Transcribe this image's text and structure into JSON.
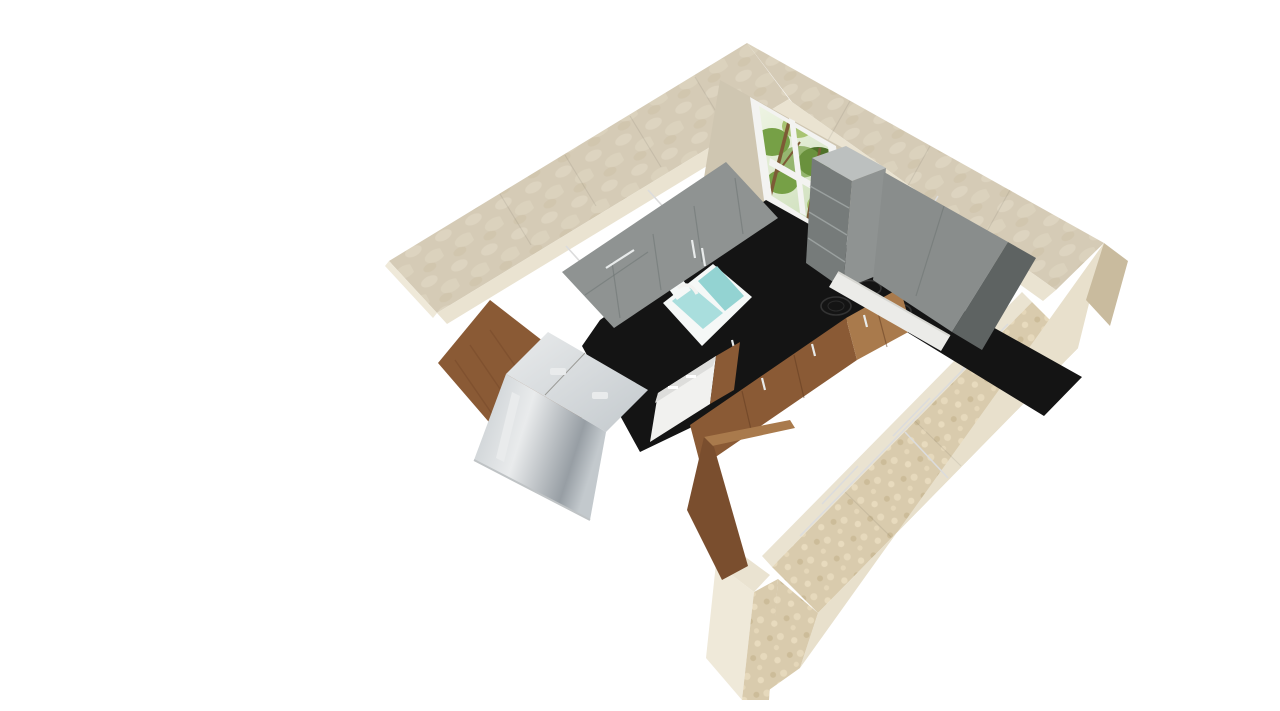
{
  "app": {
    "title": "3D Kitchen Plan View"
  },
  "canvas": {
    "width": 1280,
    "height": 711,
    "background": "#ffffff"
  },
  "colors": {
    "bg": "#ffffff",
    "wall_stone_base": "#d5cbb6",
    "wall_stone_light": "#e4dbc8",
    "wall_top_strip": "#eae3d1",
    "wall_mosaic": "#d9cbad",
    "wall_mosaic_light": "#ecdfc2",
    "wall_mosaic_dark": "#c9b894",
    "wall_outer_light": "#e8e0cc",
    "wall_outer_dark": "#c9bb9e",
    "wall_window_patch": "#cfc6b1",
    "wall_end_cap": "#efe9d9",
    "window_frame": "#f3f3f1",
    "window_sill": "#e7e7e3",
    "glass_hi": "#eef4e3",
    "glass_lo": "#cfe0bd",
    "foliage_light": "#a8c472",
    "foliage_mid": "#76a046",
    "foliage_dark": "#4e7129",
    "trunk": "#7d5a36",
    "gray_front": "#8f9392",
    "gray_face": "#898d8c",
    "gray_side_dark": "#5e6362",
    "gray_shelf_face": "#767b7a",
    "gray_shelf_front": "#9296 95",
    "gray_shelf_top": "#bcc0bf",
    "cab_top_white": "#ffffff",
    "counter_black": "#141414",
    "hood": "#ebebe8",
    "hood_shadow": "#d7d7d2",
    "wood_light": "#a97a4c",
    "wood_mid": "#8a5a35",
    "wood_dark": "#6d4226",
    "wood_side": "#7a4e2e",
    "steel_hi": "#e9ebec",
    "steel_mid": "#c3c9cd",
    "steel_dark": "#979ea4",
    "dw_body": "#f1f1ef",
    "dw_strip": "#dddddb",
    "sink_rim": "#f5f8f7",
    "sink_teal": "#a9dedd",
    "sink_teal_deep": "#93d3d2",
    "shadow_line": "#bfc3c5"
  },
  "objects": [
    {
      "label": "exterior walls with stone tile finish"
    },
    {
      "label": "window with garden foliage view"
    },
    {
      "label": "upper wall cabinets, gray fronts, white tops"
    },
    {
      "label": "open shelf end unit beside window"
    },
    {
      "label": "range hood strip"
    },
    {
      "label": "black L-shaped worktop"
    },
    {
      "label": "double-basin sink with faucet"
    },
    {
      "label": "induction cooktop with four burners"
    },
    {
      "label": "wood base cabinets with bar handles"
    },
    {
      "label": "tall wood pantry panel"
    },
    {
      "label": "stainless steel refrigerator"
    },
    {
      "label": "white dishwasher"
    },
    {
      "label": "white counter run along right wall"
    },
    {
      "label": "doorway jamb opening"
    }
  ]
}
